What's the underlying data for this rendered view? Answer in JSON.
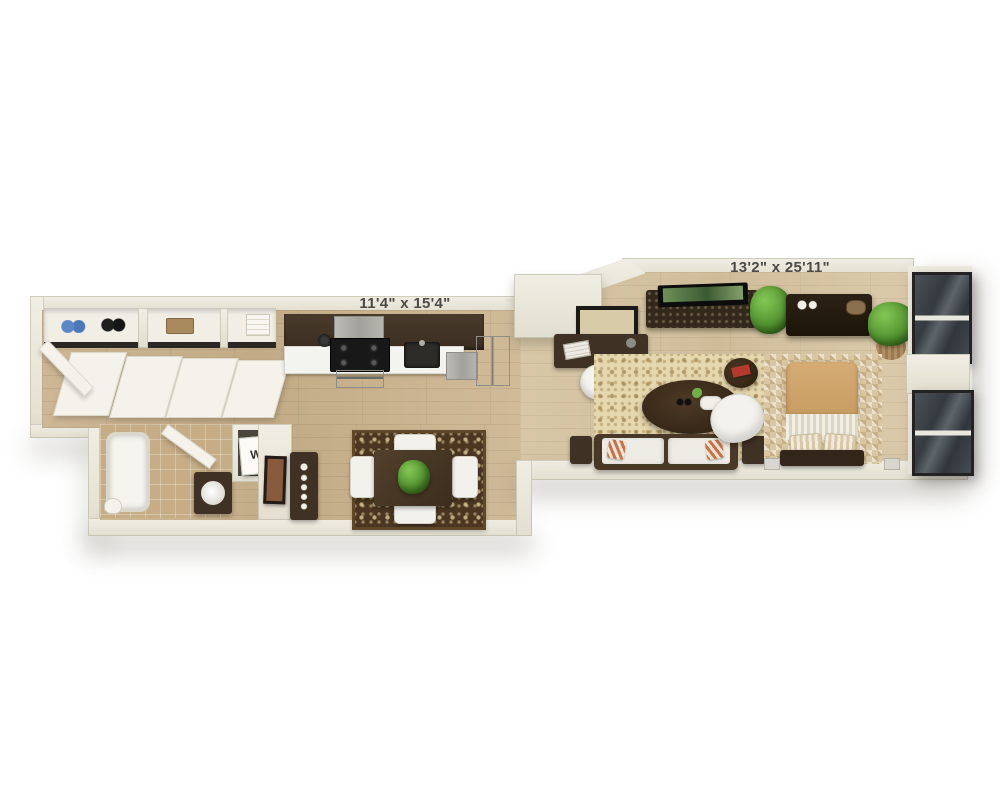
{
  "scene": {
    "type": "floorplan-3d-render",
    "background": "#ffffff"
  },
  "labels": {
    "kitchen_dining_dimensions": "11'4\" x 15'4\"",
    "living_bedroom_dimensions": "13'2\" x 25'11\"",
    "washer_dryer": "W/D"
  },
  "colors": {
    "wall": "#e8e5d8",
    "floor_wood": "#c9b28e",
    "floor_wood_light": "#d5c3a2",
    "bathroom_tile": "#c6ad85",
    "cabinets_espresso": "#3f3124",
    "countertop": "#f3f3ef",
    "appliance_steel": "#aeada7",
    "stove_black": "#181818",
    "dining_rug_base": "#4a3621",
    "dining_rug_pattern": "#decb96",
    "living_rug_base": "#e5d7ae",
    "living_rug_pattern": "#96783c",
    "bedroom_rug": "#d8c7a2",
    "sofa_cushion": "#edece4",
    "accent_pillow": "#c8714a",
    "bed_duvet": "#cfa571",
    "bed_blanket": "#efece1",
    "wood_furniture_dark": "#3a2c1e",
    "plant_green": "#549430",
    "window_glass": "#3b4146",
    "window_frame": "#232323",
    "label_text": "#4b4a45"
  },
  "rooms": {
    "entry_closet": {
      "items": [
        "entry-door",
        "closet-shelf",
        "blue-shoes",
        "black-shoes",
        "storage-box",
        "folded-towels",
        "closet-doors"
      ]
    },
    "bathroom": {
      "items": [
        "bathtub",
        "bathroom-door",
        "vanity-sink",
        "toilet"
      ]
    },
    "laundry_closet": {
      "items": [
        "washer-dryer-unit"
      ]
    },
    "hallway": {
      "items": [
        "console-table",
        "wall-art"
      ]
    },
    "kitchen": {
      "items": [
        "upper-cabinets",
        "range-hood",
        "stove",
        "oven",
        "stock-pot",
        "kitchen-sink",
        "dishwasher",
        "refrigerator",
        "countertop"
      ]
    },
    "dining": {
      "items": [
        "dining-table",
        "dining-chairs",
        "centerpiece-plant",
        "damask-rug"
      ]
    },
    "living": {
      "items": [
        "desk",
        "desk-chair",
        "wall-art",
        "tv-console",
        "tv",
        "potted-plant",
        "area-rug",
        "coffee-table",
        "sofa",
        "accent-pillows",
        "armchair",
        "side-tables",
        "end-table",
        "red-book"
      ]
    },
    "bedroom": {
      "items": [
        "dresser",
        "potted-plant",
        "checkered-rug",
        "bed",
        "bed-pillows",
        "headboard",
        "wall-sconces",
        "floor-to-ceiling-windows"
      ]
    }
  }
}
